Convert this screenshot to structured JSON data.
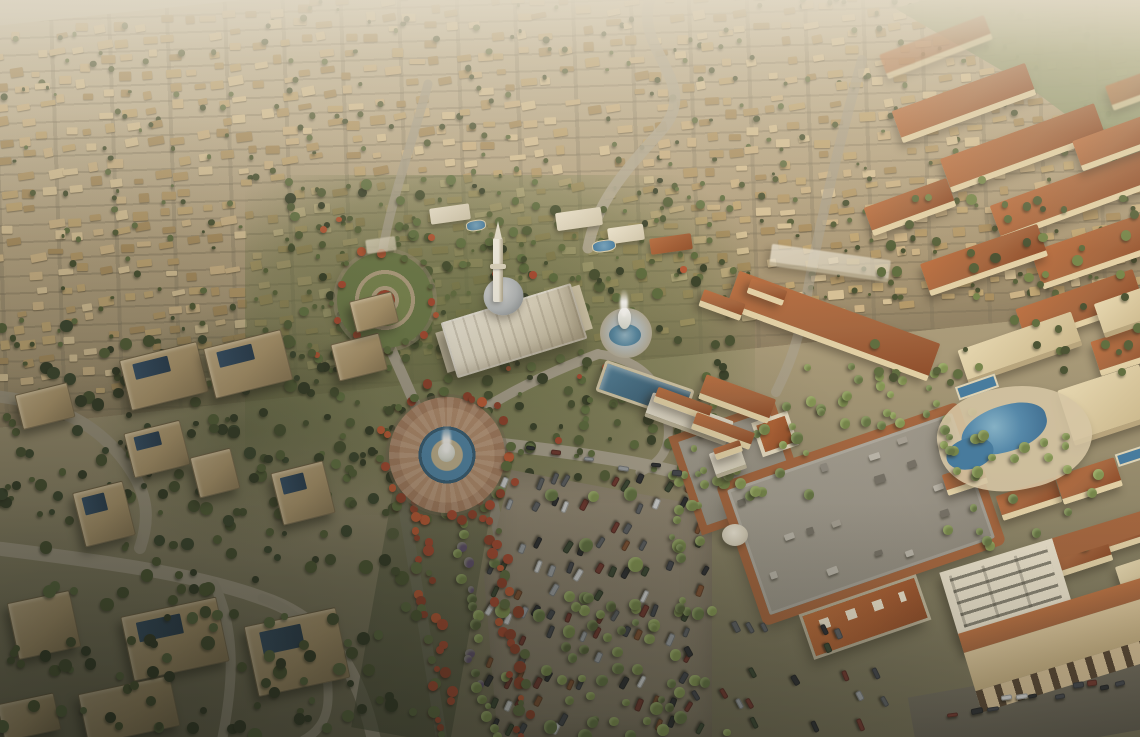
{
  "meta": {
    "description": "Aerial golden-hour rendering of a desert master-planned residential community: dense villa rows fading to haze, central white mosque with dome and minaret, fountain roundabouts, flame-tree boulevard, retail mall with surface parking, terracotta apartment blocks with lagoon pools, and large foreground villas.",
    "width": 1140,
    "height": 737,
    "visible_text": []
  },
  "palette": {
    "terracotta": "#a2603a",
    "cream": "#e2d2ac",
    "villaBeige": "#c4aa7c",
    "fieldTan": "#b3a182",
    "water": "#35607d",
    "waterBright": "#4a86b0",
    "dome": "#b6bcc1",
    "roadGray": "#a8a190",
    "asphalt": "#57544b",
    "lot": "#8b8170",
    "mallRoof": "#97938a",
    "greenDark": "#3e4a2c",
    "greenPalm": "#6f8347",
    "redFlower": "#a8432c",
    "hazeTop": "#e2ddd0"
  },
  "scene": {
    "landmarks": [
      {
        "name": "villa-field",
        "desc": "hazy rows of small beige villas covering upper half"
      },
      {
        "name": "green-fields",
        "desc": "farmland strip at top-right horizon"
      },
      {
        "name": "mosque",
        "desc": "white mosque with gray dome and tall minaret at center"
      },
      {
        "name": "garden-plaza",
        "desc": "circular landscaped plaza with concentric paths"
      },
      {
        "name": "central-fountain-roundabout",
        "desc": "paved roundabout with blue water ring and white fountain jet"
      },
      {
        "name": "white-fountain-plaza",
        "desc": "tiered white fountain with spray east of mosque"
      },
      {
        "name": "lap-pool",
        "desc": "rectangular blue community pool with clubhouse"
      },
      {
        "name": "boulevard",
        "desc": "avenue lined with red flame trees and palms running to bottom"
      },
      {
        "name": "parking-lot",
        "desc": "surface car park with palm islands"
      },
      {
        "name": "mall",
        "desc": "retail center, flat gray roof with terracotta perimeter and rooftop units"
      },
      {
        "name": "apartment-district",
        "desc": "terracotta-roofed mid-rise blocks on the right"
      },
      {
        "name": "lagoon-pool",
        "desc": "free-form resort pools in apartment courtyard"
      },
      {
        "name": "mixed-use-building",
        "desc": "bottom-right building with retail arcade and street parking"
      },
      {
        "name": "foreground-villas",
        "desc": "large shaded villas with solar panels at bottom-left"
      }
    ]
  },
  "collections": [
    {
      "container": "apartments-layer",
      "item": "apartment-block",
      "cls": "ablock",
      "items": [
        [
          880,
          34,
          112,
          26,
          -21,
          "roof hazy"
        ],
        [
          893,
          86,
          142,
          34,
          -20,
          "roof"
        ],
        [
          941,
          130,
          164,
          36,
          -20,
          "roof"
        ],
        [
          991,
          176,
          168,
          38,
          -20,
          "roof"
        ],
        [
          1033,
          226,
          152,
          40,
          -19,
          "roof"
        ],
        [
          1075,
          126,
          84,
          32,
          -20,
          "roof"
        ],
        [
          1108,
          78,
          44,
          26,
          -20,
          "roof hazy"
        ],
        [
          866,
          192,
          88,
          30,
          -20,
          "roof"
        ],
        [
          922,
          243,
          124,
          34,
          -19,
          "roof"
        ],
        [
          1018,
          288,
          124,
          38,
          -19,
          "roof"
        ],
        [
          1094,
          330,
          72,
          36,
          -18,
          "roof"
        ],
        [
          960,
          330,
          120,
          36,
          -19,
          "cream"
        ],
        [
          1064,
          376,
          86,
          58,
          -18,
          "cream"
        ],
        [
          1098,
          294,
          56,
          36,
          -19,
          "cream"
        ],
        [
          726,
          306,
          214,
          40,
          20,
          "roof"
        ],
        [
          700,
          386,
          74,
          26,
          20,
          "roof"
        ],
        [
          700,
          296,
          44,
          18,
          20,
          "roof"
        ],
        [
          748,
          284,
          38,
          16,
          20,
          "roof"
        ],
        [
          770,
          252,
          120,
          22,
          8,
          "white hazy"
        ],
        [
          646,
          406,
          86,
          26,
          20,
          "white"
        ],
        [
          654,
          396,
          58,
          16,
          20,
          "roof"
        ],
        [
          692,
          422,
          62,
          18,
          20,
          "roof"
        ],
        [
          712,
          448,
          32,
          26,
          -19,
          "white"
        ],
        [
          714,
          444,
          28,
          12,
          -19,
          "roof"
        ],
        [
          944,
          468,
          42,
          22,
          -18,
          "roof"
        ],
        [
          998,
          486,
          62,
          26,
          -18,
          "roof"
        ],
        [
          1058,
          466,
          62,
          30,
          -18,
          "roof"
        ],
        [
          1102,
          516,
          52,
          30,
          -18,
          "roof"
        ],
        [
          1038,
          538,
          72,
          34,
          -18,
          "roof"
        ],
        [
          1120,
          560,
          40,
          40,
          -18,
          "cream"
        ]
      ]
    },
    {
      "container": "villas-layer",
      "item": "villa",
      "cls": "villa",
      "items": [
        [
          18,
          388,
          54,
          36,
          -14,
          "",
          ""
        ],
        [
          124,
          350,
          80,
          52,
          -14,
          "",
          "solar"
        ],
        [
          208,
          338,
          80,
          52,
          -14,
          "",
          "solar"
        ],
        [
          128,
          426,
          58,
          46,
          -14,
          "",
          "solar"
        ],
        [
          194,
          452,
          42,
          42,
          -14,
          "",
          ""
        ],
        [
          78,
          486,
          52,
          56,
          -14,
          "",
          "solar"
        ],
        [
          276,
          466,
          54,
          54,
          -14,
          "",
          "solar"
        ],
        [
          334,
          338,
          50,
          38,
          -14,
          "",
          ""
        ],
        [
          352,
          296,
          44,
          32,
          -14,
          "",
          ""
        ],
        [
          12,
          596,
          64,
          58,
          -12,
          "",
          ""
        ],
        [
          126,
          606,
          98,
          66,
          -12,
          "",
          "solar"
        ],
        [
          250,
          616,
          94,
          72,
          -12,
          "",
          "solar"
        ],
        [
          82,
          684,
          94,
          52,
          -12,
          "",
          ""
        ],
        [
          0,
          698,
          58,
          38,
          -12,
          "",
          ""
        ]
      ]
    },
    {
      "container": "amenities-layer",
      "item": "amenity-building",
      "cls": "amenity",
      "items": [
        [
          430,
          206,
          40,
          16,
          -8,
          "white"
        ],
        [
          556,
          210,
          46,
          18,
          -8,
          "white"
        ],
        [
          608,
          226,
          36,
          16,
          -8,
          "white"
        ],
        [
          650,
          236,
          42,
          16,
          -8,
          "roof"
        ],
        [
          466,
          220,
          20,
          11,
          -8,
          "pool"
        ],
        [
          592,
          240,
          24,
          12,
          -8,
          "pool"
        ],
        [
          366,
          238,
          30,
          14,
          -8,
          "white hazy"
        ]
      ]
    }
  ],
  "generators": [
    {
      "container": "villa-field-inner",
      "item": "field-villa",
      "cls": "fvilla",
      "type": "grid",
      "seed": 11,
      "area": [
        10,
        14,
        1240,
        372
      ],
      "cell": [
        22,
        17
      ],
      "prob": 0.8,
      "w": [
        8,
        16
      ],
      "h": [
        5,
        9
      ],
      "rot": [
        -6,
        6
      ],
      "colors": [
        "#d9c49a",
        "#cdb488",
        "#c0a674",
        "#b39868",
        "#a78c5e"
      ],
      "accent": {
        "prob": 0.5,
        "w": [
          3,
          7
        ],
        "colors": [
          "#4a5631",
          "#5a6a3e",
          "#3e4a2c"
        ],
        "dx": [
          -9,
          15
        ],
        "dy": [
          -7,
          11
        ]
      }
    },
    {
      "container": "park-trees",
      "item": "tree",
      "cls": "tree",
      "type": "scatter",
      "seed": 7,
      "area": [
        285,
        180,
        445,
        300
      ],
      "n": 240,
      "w": [
        4,
        11
      ],
      "dot": true,
      "colors": [
        "#3e4a2c",
        "#4c5a34",
        "#56683a",
        "#2f3a24",
        "#5d7040"
      ],
      "accent": {
        "prob": 0.1,
        "w": [
          4,
          8
        ],
        "colors": [
          "#a8432c",
          "#b55231"
        ],
        "dx": [
          -4,
          4
        ],
        "dy": [
          -4,
          4
        ]
      }
    },
    {
      "container": "left-trees",
      "item": "tree",
      "cls": "tree",
      "type": "scatter",
      "seed": 8,
      "area": [
        0,
        325,
        400,
        235
      ],
      "n": 170,
      "w": [
        5,
        13
      ],
      "dot": true,
      "colors": [
        "#33402a",
        "#3e4a2c",
        "#4c5a34",
        "#2b3522"
      ]
    },
    {
      "container": "bottom-trees",
      "item": "tree",
      "cls": "tree",
      "type": "scatter",
      "seed": 9,
      "area": [
        0,
        556,
        420,
        181
      ],
      "n": 95,
      "w": [
        6,
        14
      ],
      "dot": true,
      "colors": [
        "#2b3522",
        "#3e4a2c",
        "#46532f",
        "#55663c"
      ]
    },
    {
      "container": "plaza-palms",
      "item": "palm-tree",
      "cls": "palm",
      "type": "scatter",
      "seed": 10,
      "area": [
        688,
        388,
        124,
        118
      ],
      "n": 30,
      "w": [
        6,
        12
      ],
      "dot": true,
      "colors": [
        "#6f8347",
        "#7e9350",
        "#5d7040"
      ]
    },
    {
      "container": "plaza-palms-n",
      "item": "palm-tree",
      "cls": "palm",
      "type": "scatter",
      "seed": 21,
      "area": [
        800,
        366,
        210,
        64
      ],
      "n": 26,
      "w": [
        6,
        11
      ],
      "dot": true,
      "colors": [
        "#6f8347",
        "#7e9350",
        "#5d7040"
      ]
    },
    {
      "container": "mall-west-palms",
      "item": "palm-tree",
      "cls": "palm",
      "type": "scatter",
      "seed": 22,
      "area": [
        672,
        468,
        42,
        160
      ],
      "n": 14,
      "w": [
        6,
        11
      ],
      "dot": true,
      "colors": [
        "#6f8347",
        "#5d7040"
      ]
    },
    {
      "container": "south-palms",
      "item": "palm-tree",
      "cls": "palm",
      "type": "scatter",
      "seed": 12,
      "area": [
        556,
        596,
        190,
        141
      ],
      "n": 42,
      "w": [
        7,
        13
      ],
      "dot": true,
      "colors": [
        "#6f8347",
        "#7e9350",
        "#5d7040",
        "#4c5a34"
      ]
    },
    {
      "container": "blvd-left-trees",
      "item": "flame-tree",
      "cls": "flower",
      "type": "strip",
      "seed": 13,
      "p1": [
        412,
        468
      ],
      "p2": [
        448,
        737
      ],
      "halfw": 11,
      "n": 36,
      "w": [
        6,
        12
      ],
      "dot": true,
      "colors": [
        "#a8432c",
        "#c05531",
        "#8f3a26",
        "#5a6a3e"
      ]
    },
    {
      "container": "blvd-right-trees",
      "item": "flame-tree",
      "cls": "flower",
      "type": "strip",
      "seed": 14,
      "p1": [
        484,
        468
      ],
      "p2": [
        528,
        737
      ],
      "halfw": 11,
      "n": 36,
      "w": [
        6,
        12
      ],
      "dot": true,
      "colors": [
        "#a8432c",
        "#c05531",
        "#8f3a26",
        "#5a6a3e"
      ]
    },
    {
      "container": "blvd-mid-palms",
      "item": "palm-tree",
      "cls": "palm",
      "type": "strip",
      "seed": 15,
      "p1": [
        448,
        470
      ],
      "p2": [
        488,
        737
      ],
      "halfw": 9,
      "n": 26,
      "w": [
        6,
        11
      ],
      "dot": true,
      "colors": [
        "#6f8347",
        "#7e9350",
        "#5a4a6e",
        "#4c5a34"
      ]
    },
    {
      "container": "roundabout-flowers",
      "item": "flame-tree",
      "cls": "flower",
      "type": "ring",
      "seed": 16,
      "c": [
        447,
        455
      ],
      "r": [
        60,
        74
      ],
      "n": 28,
      "w": [
        6,
        11
      ],
      "dot": true,
      "colors": [
        "#a8432c",
        "#c05531",
        "#56683a",
        "#8f3a26"
      ]
    },
    {
      "container": "garden-flowers",
      "item": "flame-tree",
      "cls": "flower",
      "type": "ring",
      "seed": 17,
      "c": [
        385,
        300
      ],
      "r": [
        44,
        56
      ],
      "n": 16,
      "w": [
        5,
        9
      ],
      "dot": true,
      "colors": [
        "#a8432c",
        "#b55231",
        "#56683a"
      ]
    },
    {
      "container": "parking-cars",
      "item": "car",
      "cls": "car",
      "type": "grid",
      "seed": 18,
      "area": [
        492,
        482,
        212,
        248
      ],
      "cell": [
        15,
        22
      ],
      "prob": 0.5,
      "w": [
        10,
        13
      ],
      "h": [
        5,
        6
      ],
      "rot": [
        110,
        122
      ],
      "colors": [
        "#22262e",
        "#3a3f4a",
        "#9aa0a8",
        "#d5d8dc",
        "#6b2f2a",
        "#31402f",
        "#555a62",
        "#7a4a2e"
      ]
    },
    {
      "container": "parking-palms",
      "item": "palm-tree",
      "cls": "palm",
      "type": "grid",
      "seed": 19,
      "area": [
        502,
        494,
        196,
        236
      ],
      "cell": [
        46,
        58
      ],
      "prob": 0.85,
      "w": [
        9,
        15
      ],
      "dot": true,
      "colors": [
        "#6f8347",
        "#7e9350",
        "#5d7040"
      ]
    },
    {
      "container": "south-cars",
      "item": "car",
      "cls": "car",
      "type": "grid",
      "seed": 20,
      "area": [
        692,
        630,
        205,
        100
      ],
      "cell": [
        15,
        23
      ],
      "prob": 0.38,
      "w": [
        10,
        13
      ],
      "h": [
        5,
        6
      ],
      "rot": [
        58,
        70
      ],
      "colors": [
        "#22262e",
        "#3a3f4a",
        "#9aa0a8",
        "#6b2f2a",
        "#31402f",
        "#555a62"
      ]
    },
    {
      "container": "mall-roof-units",
      "item": "rooftop-ac-unit",
      "cls": "acunit",
      "type": "grid",
      "seed": 23,
      "area": [
        16,
        14,
        206,
        104
      ],
      "cell": [
        27,
        25
      ],
      "prob": 0.45,
      "w": [
        7,
        11
      ],
      "h": [
        5,
        8
      ],
      "rot": [
        -2,
        2
      ],
      "colors": [
        "#b9b6ae",
        "#8a8780",
        "#6e6b64",
        "#a39f96"
      ]
    },
    {
      "container": "apt-trees",
      "item": "tree",
      "cls": "tree",
      "type": "scatter",
      "seed": 24,
      "area": [
        856,
        180,
        284,
        210
      ],
      "n": 55,
      "w": [
        5,
        11
      ],
      "dot": true,
      "colors": [
        "#4c5a34",
        "#56683a",
        "#6f8347",
        "#3e4a2c"
      ]
    },
    {
      "container": "lagoon-palms",
      "item": "palm-tree",
      "cls": "palm",
      "type": "scatter",
      "seed": 25,
      "area": [
        935,
        425,
        170,
        130
      ],
      "n": 30,
      "w": [
        6,
        12
      ],
      "dot": true,
      "colors": [
        "#6f8347",
        "#7e9350",
        "#5d7040"
      ]
    },
    {
      "container": "street-cars-br",
      "item": "car",
      "cls": "car",
      "type": "strip",
      "seed": 26,
      "p1": [
        944,
        714
      ],
      "p2": [
        1136,
        678
      ],
      "halfw": 6,
      "n": 11,
      "w": [
        9,
        13
      ],
      "h": [
        4,
        6
      ],
      "rot": [
        -14,
        -6
      ],
      "colors": [
        "#22262e",
        "#9aa0a8",
        "#6b2f2a",
        "#3a3f4a",
        "#d5d8dc"
      ]
    },
    {
      "container": "road-cars",
      "item": "car",
      "cls": "car",
      "type": "strip",
      "seed": 27,
      "p1": [
        520,
        452
      ],
      "p2": [
        690,
        473
      ],
      "halfw": 5,
      "n": 6,
      "w": [
        9,
        12
      ],
      "h": [
        4,
        6
      ],
      "rot": [
        4,
        10
      ],
      "colors": [
        "#22262e",
        "#9aa0a8",
        "#6b2f2a",
        "#3a3f4a"
      ]
    }
  ]
}
